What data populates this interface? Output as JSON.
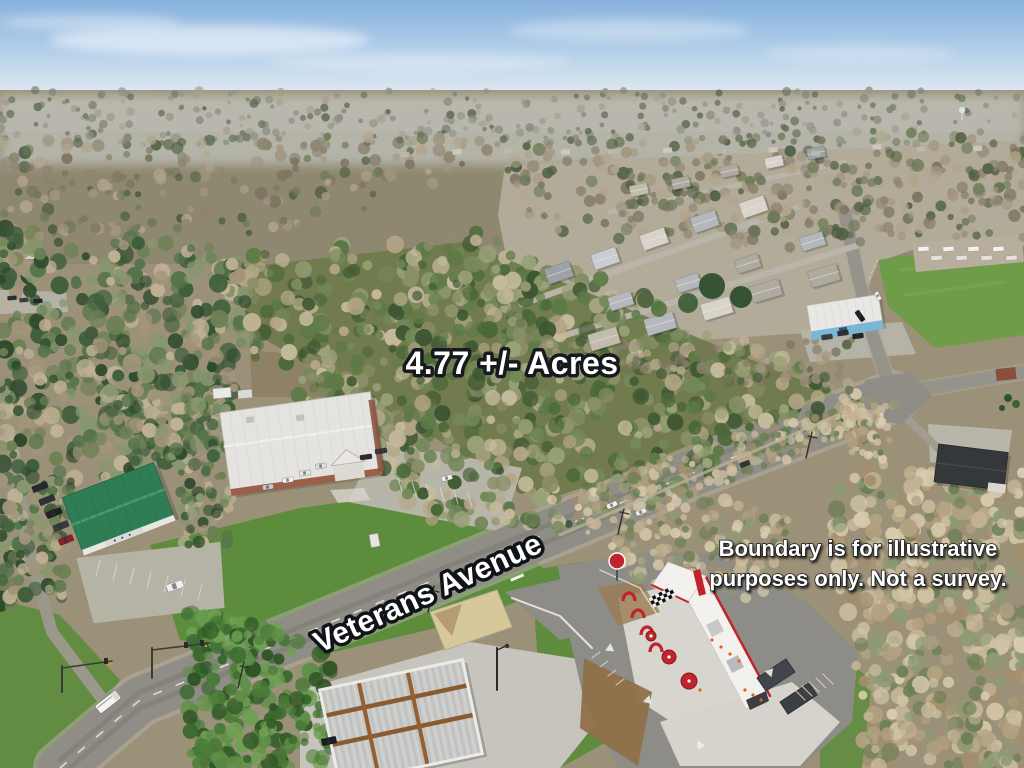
{
  "annotations": {
    "acreage": "4.77 +/- Acres",
    "street": "Veterans Avenue",
    "disclaimer_line1": "Boundary is for illustrative",
    "disclaimer_line2": "purposes only. Not a survey."
  },
  "boundary": {
    "color": "#ffffff",
    "shadow": "rgba(0,0,0,0.35)",
    "stroke_width": 7,
    "dash": [
      22,
      15
    ],
    "points": [
      [
        262,
        312
      ],
      [
        443,
        257
      ],
      [
        815,
        402
      ],
      [
        542,
        500
      ]
    ]
  },
  "colors": {
    "sky_top": "#86b1dd",
    "sky_mid": "#b8d2ea",
    "sky_horizon": "#e7eef3",
    "haze": "#dfe7ec",
    "ground": "#9b9179",
    "ground2": "#8e8770",
    "subdivision_ground": "#b2ab9a",
    "road": "#8f8d85",
    "road_edge": "#b3afa2",
    "road_minor": "#96938a",
    "street": "#b9b5aa",
    "concrete": "#cdcbc2",
    "concrete_bright": "#d7d5ce",
    "dirt": "#8f7148",
    "dirt_warm": "#9a7c52",
    "lawn": "#5c8c3c",
    "pasture": "#6f9c49",
    "island_sand": "#d6c89b",
    "roof_green": "#2f7d54",
    "roof_green_hi": "#4a9a6c",
    "building_blue": "#7ab7d6",
    "white_bldg": "#f2f1ee",
    "brand_red": "#c1242e",
    "rust": "#8a5a30",
    "canopy_dark": "#42464a",
    "dark_roof": "#35383b",
    "palettes": {
      "distant": [
        "#8b8f80",
        "#7a8270",
        "#6a7360",
        "#959787",
        "#5c6850",
        "#a3a08c"
      ],
      "mid": [
        "#8d8470",
        "#a2967f",
        "#6f7a57",
        "#4e5e41",
        "#b2a58b",
        "#7d7461"
      ],
      "parcel": [
        "#5d7a46",
        "#4a6838",
        "#74895a",
        "#b4a687",
        "#c6ba9d",
        "#8a8f66",
        "#3e5732",
        "#99a177"
      ],
      "leftwood": [
        "#3f5e3b",
        "#54734a",
        "#a3957b",
        "#c0b294",
        "#2e4a2d",
        "#87976f",
        "#6d8054"
      ],
      "bare": [
        "#c2b293",
        "#b3a181",
        "#cfc1a3",
        "#8e9a75",
        "#a28e6e",
        "#d8cbae",
        "#6d7f55"
      ],
      "lush": [
        "#4a7a38",
        "#5f8f47",
        "#38682d",
        "#6fa054",
        "#2f5526"
      ],
      "suburb": [
        "#5d7a46",
        "#a3957b",
        "#c0b294",
        "#4a6838",
        "#8e9a75"
      ],
      "roofs": [
        "#b4b8bc",
        "#c9ccd0",
        "#9ba2a8",
        "#d8d4ca",
        "#8f969c",
        "#c2bcae",
        "#aeaaa0"
      ]
    }
  }
}
